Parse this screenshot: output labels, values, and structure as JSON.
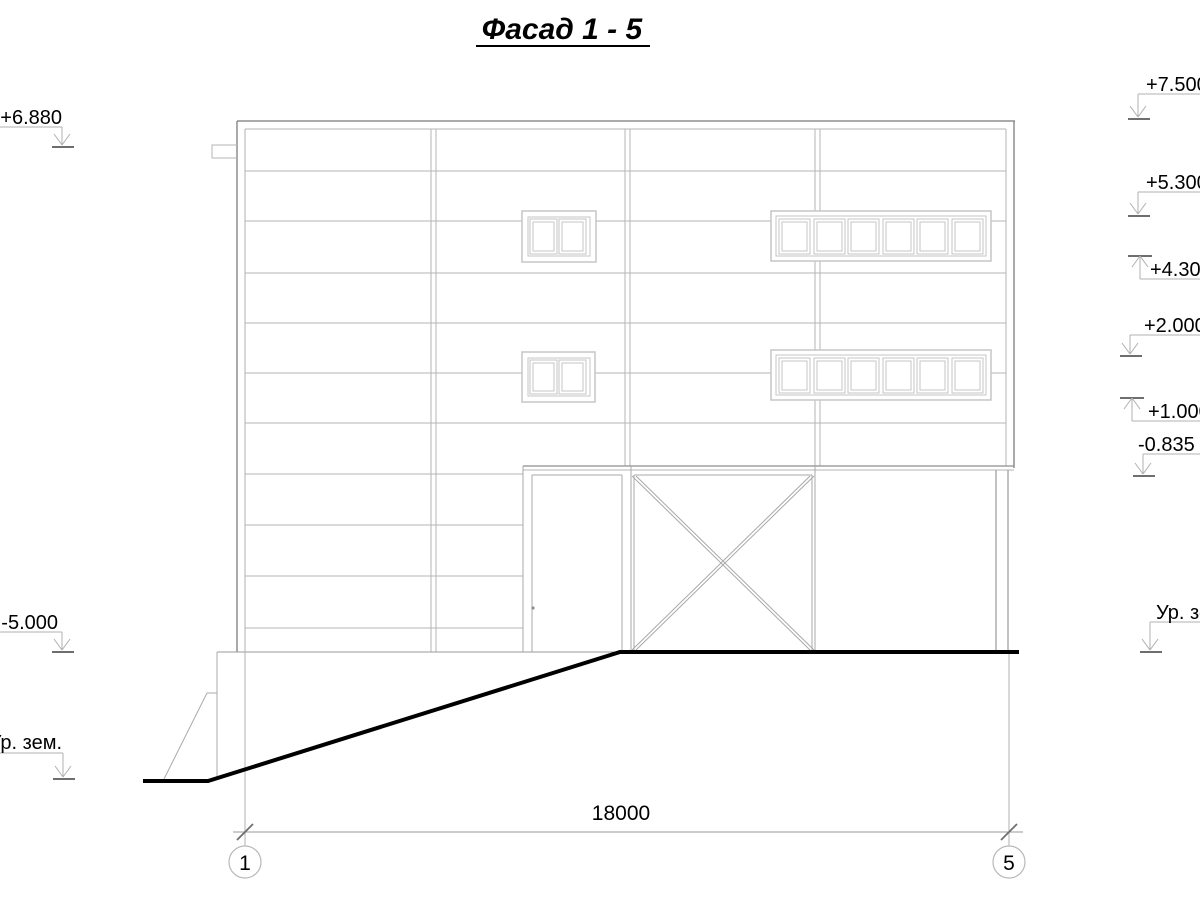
{
  "title": "Фасад 1 - 5",
  "drawing": {
    "type": "architectural-facade-elevation",
    "dimension_total": "18000",
    "grid_axes": [
      {
        "label": "1"
      },
      {
        "label": "5"
      }
    ],
    "elevation_marks_left": [
      {
        "label": "+6.880"
      },
      {
        "label": "-5.000"
      },
      {
        "label": "Ур. зем."
      }
    ],
    "elevation_marks_right": [
      {
        "label": "+7.500"
      },
      {
        "label": "+5.300"
      },
      {
        "label": "+4.300"
      },
      {
        "label": "+2.000"
      },
      {
        "label": "+1.000"
      },
      {
        "label": "-0.835"
      },
      {
        "label": "Ур. зем."
      }
    ],
    "colors": {
      "outline": "#8e8e8e",
      "secondary": "#a8a8a8",
      "light_line": "#b6b6b6",
      "window_frame": "#c6c6c6",
      "leader": "#b0b0b0",
      "level_tick": "#6e6e6e",
      "ground_line": "#000000",
      "text": "#000000"
    }
  }
}
